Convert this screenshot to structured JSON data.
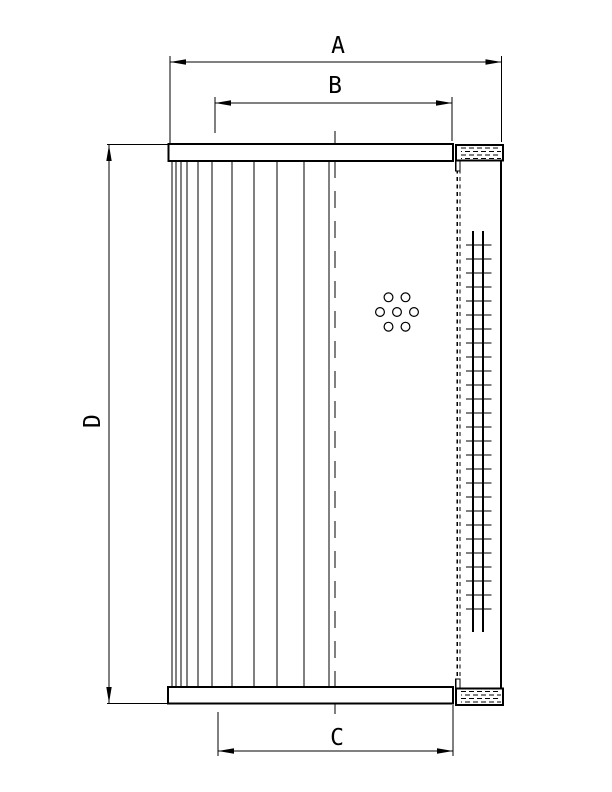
{
  "drawing": {
    "background": "#ffffff",
    "ink": "#000000",
    "labels": {
      "a": "A",
      "b": "B",
      "c": "C",
      "d": "D"
    },
    "front_view": {
      "top_cap": {
        "x": 168.5,
        "y": 144,
        "w": 284.5,
        "h": 17
      },
      "bottom_cap": {
        "x": 168,
        "y": 687,
        "w": 285,
        "h": 16.5
      },
      "pleats": {
        "xs": [
          172,
          176,
          181,
          187,
          198,
          212,
          232,
          254,
          277,
          304,
          329
        ],
        "y1": 161,
        "y2": 687
      },
      "centerline": {
        "x": 335,
        "y1": 131,
        "y2": 714,
        "dash": "17 13"
      },
      "perforations": {
        "cx": 397,
        "cy": 312,
        "hole_radius": 4.4,
        "ring_radius": 17,
        "ring_count": 6
      }
    },
    "side_view": {
      "top_cap": {
        "x": 456,
        "y": 145,
        "w": 47,
        "h": 15.5
      },
      "bottom_cap": {
        "x": 456,
        "y": 688.5,
        "w": 47,
        "h": 16.5
      },
      "top_lip": {
        "x": 455.8,
        "y": 145,
        "w": 4.2,
        "h": 26
      },
      "bottom_lip": {
        "x": 455.8,
        "y": 679,
        "w": 4.2,
        "h": 26
      },
      "right_edge": {
        "x": 501,
        "y1": 145,
        "y2": 705
      },
      "hidden_edges": {
        "xs": [
          457.2,
          459.8
        ],
        "y1": 162,
        "y2": 687,
        "dash": "4 3.5"
      },
      "mesh": {
        "rail_xs": [
          473,
          483
        ],
        "rail_y1": 231,
        "rail_y2": 632,
        "rung_x1": 466,
        "rung_x2": 491.5,
        "rung_y_start": 245,
        "rung_spacing": 14,
        "rung_count": 27
      }
    },
    "dimensions": {
      "a": {
        "orientation": "horizontal",
        "line_y": 62,
        "x1": 170,
        "x2": 501.5,
        "extensions": [
          {
            "x": 170,
            "y1": 56,
            "y2": 143
          },
          {
            "x": 501.5,
            "y1": 56,
            "y2": 142
          }
        ]
      },
      "b": {
        "orientation": "horizontal",
        "line_y": 103,
        "x1": 215,
        "x2": 452,
        "extensions": [
          {
            "x": 215,
            "y1": 97,
            "y2": 133
          },
          {
            "x": 452,
            "y1": 97,
            "y2": 141
          }
        ]
      },
      "c": {
        "orientation": "horizontal",
        "line_y": 751,
        "x1": 218,
        "x2": 453,
        "extensions": [
          {
            "x": 218,
            "y1": 712,
            "y2": 756
          },
          {
            "x": 453,
            "y1": 705,
            "y2": 756
          }
        ]
      },
      "d": {
        "orientation": "vertical",
        "line_x": 109,
        "y1": 145,
        "y2": 703,
        "extensions": [
          {
            "y": 144.5,
            "x1": 107,
            "x2": 168.5
          },
          {
            "y": 703.5,
            "x1": 107,
            "x2": 168
          }
        ]
      }
    }
  }
}
